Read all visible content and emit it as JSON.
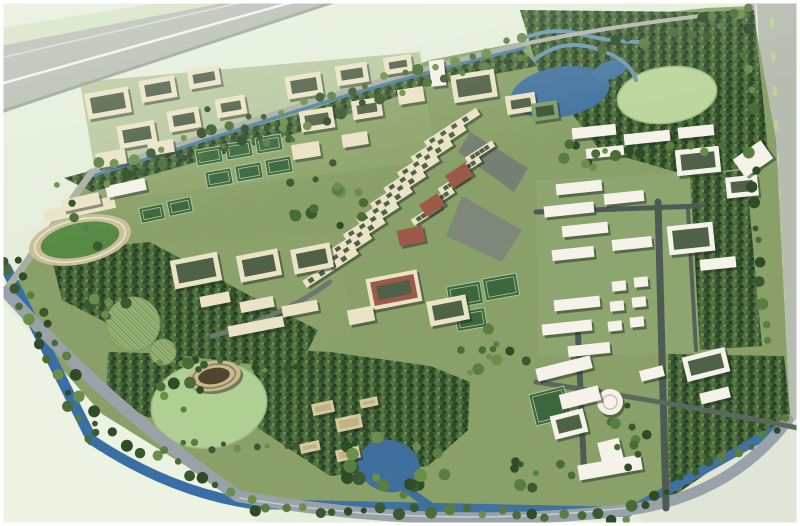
{
  "meta": {
    "description": "aerial-rendering-campus-master-plan"
  },
  "colors": {
    "bgOutside": "#e4eeda",
    "bgLightBL": "#edf3e3",
    "bgBR": "#dfe6d8",
    "hwGrey": "#b6bcb0",
    "hwLine": "#f0f3ec",
    "hwLine2": "#d7ddd0",
    "hwEdge": "#9aa296",
    "verge": "#d3e2c2",
    "dash": "#c3cf97",
    "siteGreen": "#89a168",
    "tintA": "#93ab70",
    "tintB": "#8ca46c",
    "tintC": "#90a973",
    "lawnLight": "#bcd69d",
    "lawnLight2": "#b0cf92",
    "lawnRing": "#9cbc7d",
    "waterBlue": "#3a6fa6",
    "waterBlue2": "#3f72a0",
    "waterTeal": "#4e80a2",
    "lake": "#44759f",
    "stream": "#6c98b0",
    "pond": "#3e6f9d",
    "plaza": "#7f877a",
    "plaza2": "#757f72",
    "track": "#c9bf98",
    "field": "#568a44",
    "fieldLine": "#e9e6d2",
    "cream": "#eae3c5",
    "white": "#f4f2e9",
    "tanBldg": "#d5c9a0",
    "tanBldg2": "#c2b183",
    "redRoof": "#9e5a48",
    "greenRoof": "#7ea06a",
    "greenRoofIn": "#3d5537",
    "courtyardIn": "#4f6147",
    "shadow": "rgba(35,45,35,0.5)",
    "court": "#3c663c",
    "courtLine": "#a9c79a",
    "hatchFill": "#96b274",
    "hatchRing": "#7c9a5e",
    "amph": "#c9b88f",
    "amphIn": "#50452f",
    "amphRing": "#8a7a58",
    "domeRing": "#c9c4b2",
    "frame": "#ffffff",
    "treePalette": [
      "#2f4c28",
      "#3a5930",
      "#4a6c37",
      "#5a7d41",
      "#6b8e4a"
    ]
  },
  "scene": {
    "site_polygon": "8,296 90,170 300,108 430,60 522,42 610,18 706,8 752,6 776,140 790,416 700,484 626,510 430,516 240,496 98,422",
    "tl_highway": "0,46 0,114 336,0 238,0",
    "tl_verge": "0,28 0,46 238,0 176,0",
    "r_highway": "750,0 800,0 800,526 776,526 758,140",
    "bl_outside": "0,300 102,414 238,498 260,526 0,526",
    "br_outside": "636,514 790,424 800,416 800,526 646,526",
    "tintA": "80,82 420,52 436,160 100,202",
    "tintB": "150,242 340,232 352,338 162,350",
    "tintC": "536,180 702,172 712,352 538,356",
    "plaza1": "462,196 522,230 502,262 446,236",
    "plaza2": "470,132 528,168 514,192 458,152",
    "forests": [
      "520,10 700,12 754,10 768,150 742,168 690,176 600,150 538,70",
      "690,176 746,170 762,346 700,350",
      "668,354 784,356 790,414 700,478 668,500",
      "252,348 330,352 430,366 470,382 468,430 428,466 330,476 258,428",
      "50,252 150,242 258,300 318,330 298,370 168,354 62,300",
      "64,178 300,114 430,66 520,48 538,66 420,88 300,132 92,192",
      "108,352 180,354 208,370 198,398 150,418 106,400"
    ],
    "water": [
      {
        "t": "p",
        "d": "M6,268 L92,440",
        "w": 11,
        "c": "#3a6fa6"
      },
      {
        "t": "p",
        "d": "M92,440 Q170,492 252,504",
        "w": 10,
        "c": "#3a6fa6"
      },
      {
        "t": "p",
        "d": "M252,504 L628,512",
        "w": 10,
        "c": "#3f72a0"
      },
      {
        "t": "p",
        "d": "M628,512 L786,424",
        "w": 9,
        "c": "#3f72a0"
      },
      {
        "t": "p",
        "d": "M90,174 C240,128 360,84 522,46",
        "w": 8,
        "c": "#4e80a2"
      },
      {
        "t": "e",
        "cx": 560,
        "cy": 92,
        "rx": 50,
        "ry": 25,
        "rot": -10,
        "c": "#44759f"
      },
      {
        "t": "e",
        "cx": 610,
        "cy": 70,
        "rx": 18,
        "ry": 9,
        "rot": -20,
        "c": "#4a7aa0"
      },
      {
        "t": "p",
        "d": "M520,40 q30,-14 60,-6 t60,8",
        "w": 4,
        "c": "#6c98b0"
      },
      {
        "t": "p",
        "d": "M534,60 q30,-24 66,-10 q30,10 36,30",
        "w": 4,
        "c": "#6c98b0"
      },
      {
        "t": "e",
        "cx": 389,
        "cy": 466,
        "rx": 31,
        "ry": 26,
        "rot": 15,
        "c": "#3e6f9d"
      },
      {
        "t": "p",
        "d": "M402,486 L436,510",
        "w": 8,
        "c": "#3e6f9d"
      }
    ],
    "roads": [
      {
        "d": "M6,290 L92,172",
        "w": 7,
        "c": "#a8afa0"
      },
      {
        "d": "M92,172 C240,126 360,82 524,44",
        "w": 5,
        "c": "#a8afa0"
      },
      {
        "d": "M524,44 Q600,28 700,16",
        "w": 4,
        "c": "#b0b8ab"
      },
      {
        "d": "M6,292 Q110,408 238,496",
        "w": 12,
        "c": "#99a2a8"
      },
      {
        "d": "M238,496 Q430,532 628,510",
        "w": 12,
        "c": "#99a2a8"
      },
      {
        "d": "M628,510 Q730,496 788,420",
        "w": 11,
        "c": "#99a2a8"
      },
      {
        "d": "M240,498 Q430,530 626,508",
        "w": 1.5,
        "c": "#c8ced2"
      },
      {
        "d": "M658,202 L666,508",
        "w": 7,
        "c": "#4e5a54"
      },
      {
        "d": "M578,334 L584,470",
        "w": 6,
        "c": "#4e5a54"
      },
      {
        "d": "M536,212 L700,206",
        "w": 5,
        "c": "#4e5a54"
      },
      {
        "d": "M688,210 L696,350",
        "w": 4,
        "c": "#55625a"
      },
      {
        "d": "M536,382 Q680,404 798,428",
        "w": 5,
        "c": "#5a6860"
      },
      {
        "d": "M330,282 Q280,318 212,336",
        "w": 5,
        "c": "#6e786e"
      }
    ],
    "dashes": {
      "x1": 770,
      "y1": 18,
      "x2": 789,
      "y2": 498,
      "n": 15,
      "w": 4,
      "h": 9
    },
    "axis": [
      {
        "x": 452,
        "y": 128,
        "dx": -13.5,
        "dy": 15.5,
        "n": 10,
        "len": 62,
        "th": 8,
        "rot": -33
      },
      {
        "x": 480,
        "y": 152,
        "dx": -13.5,
        "dy": 15.5,
        "n": 5,
        "len": 32,
        "th": 7,
        "rot": -33
      }
    ],
    "buildings": [
      [
        86,
        90,
        44,
        26,
        -10,
        "cc"
      ],
      [
        140,
        78,
        36,
        22,
        -10,
        "cc"
      ],
      [
        188,
        68,
        32,
        19,
        -10,
        "cc"
      ],
      [
        118,
        123,
        38,
        23,
        -10,
        "cc"
      ],
      [
        168,
        109,
        32,
        21,
        -10,
        "cc"
      ],
      [
        216,
        97,
        30,
        19,
        -10,
        "cc"
      ],
      [
        96,
        151,
        30,
        15,
        -10,
        "c"
      ],
      [
        148,
        141,
        26,
        13,
        -10,
        "c"
      ],
      [
        286,
        74,
        36,
        23,
        -9,
        "cc"
      ],
      [
        336,
        64,
        32,
        20,
        -9,
        "cc"
      ],
      [
        384,
        56,
        28,
        17,
        -9,
        "cc"
      ],
      [
        300,
        109,
        34,
        21,
        -9,
        "cc"
      ],
      [
        352,
        99,
        30,
        19,
        -9,
        "cc"
      ],
      [
        398,
        88,
        26,
        15,
        -9,
        "c"
      ],
      [
        292,
        143,
        28,
        15,
        -9,
        "c"
      ],
      [
        342,
        133,
        26,
        13,
        -9,
        "c"
      ],
      [
        452,
        72,
        44,
        28,
        -9,
        "cc"
      ],
      [
        506,
        94,
        30,
        19,
        -9,
        "cc"
      ],
      [
        532,
        102,
        26,
        18,
        -8,
        "g"
      ],
      [
        430,
        60,
        15,
        26,
        -6,
        "w"
      ],
      [
        62,
        196,
        38,
        12,
        -12,
        "c"
      ],
      [
        106,
        182,
        40,
        12,
        -12,
        "w"
      ],
      [
        172,
        256,
        48,
        29,
        -11,
        "cc"
      ],
      [
        238,
        252,
        42,
        27,
        -11,
        "cc"
      ],
      [
        292,
        246,
        40,
        25,
        -11,
        "cc"
      ],
      [
        200,
        294,
        30,
        11,
        -11,
        "c"
      ],
      [
        240,
        299,
        34,
        11,
        -11,
        "c"
      ],
      [
        282,
        303,
        36,
        11,
        -11,
        "c"
      ],
      [
        228,
        321,
        56,
        11,
        -11,
        "c"
      ],
      [
        447,
        168,
        24,
        15,
        -33,
        "r"
      ],
      [
        421,
        198,
        22,
        14,
        -33,
        "r"
      ],
      [
        398,
        228,
        26,
        16,
        -12,
        "r"
      ],
      [
        368,
        274,
        52,
        32,
        -11,
        "rc"
      ],
      [
        428,
        298,
        40,
        25,
        -11,
        "cc"
      ],
      [
        348,
        308,
        26,
        15,
        -11,
        "c"
      ],
      [
        572,
        126,
        44,
        11,
        -6,
        "w"
      ],
      [
        624,
        132,
        46,
        11,
        -6,
        "w"
      ],
      [
        678,
        126,
        36,
        11,
        -6,
        "w"
      ],
      [
        586,
        147,
        38,
        10,
        -6,
        "w"
      ],
      [
        676,
        148,
        44,
        26,
        -6,
        "wc"
      ],
      [
        726,
        176,
        32,
        21,
        -6,
        "wc"
      ],
      [
        556,
        182,
        46,
        11,
        -6,
        "w"
      ],
      [
        544,
        204,
        50,
        11,
        -6,
        "w"
      ],
      [
        604,
        192,
        40,
        11,
        -6,
        "w"
      ],
      [
        562,
        224,
        46,
        11,
        -6,
        "w"
      ],
      [
        612,
        238,
        40,
        11,
        -6,
        "w"
      ],
      [
        552,
        248,
        42,
        11,
        -6,
        "w"
      ],
      [
        668,
        224,
        46,
        29,
        -6,
        "wc"
      ],
      [
        700,
        258,
        36,
        11,
        -6,
        "w"
      ],
      [
        554,
        298,
        46,
        11,
        -6,
        "w"
      ],
      [
        542,
        322,
        50,
        11,
        -6,
        "w"
      ],
      [
        568,
        344,
        42,
        11,
        -6,
        "w"
      ],
      [
        612,
        281,
        14,
        10,
        -6,
        "w"
      ],
      [
        634,
        277,
        14,
        10,
        -6,
        "w"
      ],
      [
        610,
        301,
        14,
        10,
        -6,
        "w"
      ],
      [
        632,
        297,
        14,
        10,
        -6,
        "w"
      ],
      [
        608,
        321,
        14,
        10,
        -6,
        "w"
      ],
      [
        630,
        317,
        14,
        10,
        -6,
        "w"
      ],
      [
        536,
        362,
        56,
        13,
        -14,
        "w"
      ],
      [
        560,
        390,
        40,
        15,
        -14,
        "w"
      ],
      [
        552,
        412,
        34,
        24,
        -14,
        "wc"
      ],
      [
        600,
        440,
        22,
        26,
        -14,
        "w"
      ],
      [
        578,
        460,
        64,
        15,
        -10,
        "w"
      ],
      [
        684,
        352,
        44,
        25,
        -14,
        "wc"
      ],
      [
        700,
        390,
        30,
        11,
        -14,
        "w"
      ],
      [
        640,
        368,
        24,
        11,
        -14,
        "w"
      ],
      [
        312,
        402,
        22,
        12,
        -12,
        "t"
      ],
      [
        336,
        416,
        26,
        14,
        -12,
        "t"
      ],
      [
        300,
        442,
        20,
        10,
        -12,
        "t"
      ],
      [
        336,
        448,
        24,
        12,
        -12,
        "t"
      ],
      [
        360,
        398,
        18,
        9,
        -12,
        "t"
      ],
      [
        736,
        148,
        34,
        22,
        -35,
        "w"
      ]
    ],
    "courts": [
      [
        196,
        148,
        26,
        16,
        -10
      ],
      [
        226,
        142,
        26,
        16,
        -10
      ],
      [
        256,
        136,
        26,
        16,
        -10
      ],
      [
        206,
        170,
        26,
        16,
        -10
      ],
      [
        236,
        164,
        26,
        16,
        -10
      ],
      [
        266,
        158,
        26,
        16,
        -10
      ],
      [
        140,
        206,
        24,
        15,
        -12
      ],
      [
        168,
        199,
        24,
        15,
        -12
      ],
      [
        448,
        284,
        34,
        22,
        -10
      ],
      [
        484,
        276,
        34,
        22,
        -10
      ],
      [
        456,
        310,
        30,
        19,
        -10
      ],
      [
        532,
        390,
        36,
        32,
        -14
      ]
    ],
    "tree_belts": [
      [
        96,
        166,
        520,
        40,
        26,
        4
      ],
      [
        104,
        184,
        524,
        56,
        22,
        4
      ],
      [
        0,
        258,
        86,
        436,
        13,
        4
      ],
      [
        18,
        258,
        98,
        428,
        11,
        4
      ],
      [
        100,
        428,
        248,
        502,
        11,
        4
      ],
      [
        252,
        508,
        630,
        516,
        24,
        4
      ],
      [
        632,
        510,
        788,
        422,
        13,
        4
      ],
      [
        744,
        14,
        766,
        340,
        18,
        4
      ],
      [
        162,
        360,
        298,
        368,
        10,
        3
      ],
      [
        166,
        446,
        298,
        450,
        10,
        3
      ],
      [
        600,
        46,
        722,
        30,
        9,
        4
      ],
      [
        614,
        152,
        718,
        148,
        8,
        4
      ],
      [
        60,
        186,
        96,
        246,
        5,
        4
      ],
      [
        700,
        16,
        748,
        10,
        4,
        4
      ]
    ],
    "tree_clusters": [
      [
        328,
        198,
        42,
        36,
        14,
        4
      ],
      [
        390,
        466,
        58,
        30,
        16,
        5
      ],
      [
        586,
        150,
        30,
        20,
        8,
        4
      ],
      [
        482,
        348,
        52,
        26,
        12,
        4
      ],
      [
        250,
        122,
        60,
        28,
        9,
        3
      ],
      [
        626,
        432,
        30,
        36,
        10,
        4
      ],
      [
        184,
        386,
        30,
        26,
        8,
        4
      ],
      [
        540,
        470,
        40,
        20,
        8,
        4
      ],
      [
        120,
        300,
        40,
        24,
        8,
        4
      ]
    ],
    "stadium": {
      "cx": 80,
      "cy": 240,
      "rot": -12,
      "trx": 52,
      "try": 24,
      "frx": 40,
      "fry": 17
    },
    "amphitheater": {
      "cx": 214,
      "cy": 376,
      "rot": -10,
      "orx": 27,
      "ory": 15,
      "irx": 16,
      "iry": 8
    },
    "dome_building": {
      "cx": 610,
      "cy": 402,
      "r": 13
    },
    "lawn_ne": {
      "cx": 667,
      "cy": 95,
      "rx": 50,
      "ry": 28,
      "rot": -8
    },
    "lawn_sw": {
      "cx": 209,
      "cy": 405,
      "rx": 58,
      "ry": 43,
      "rot": -8
    },
    "hatch_circle_1": {
      "cx": 133,
      "cy": 324,
      "r": 27
    },
    "hatch_circle_2": {
      "cx": 163,
      "cy": 352,
      "r": 13
    }
  }
}
